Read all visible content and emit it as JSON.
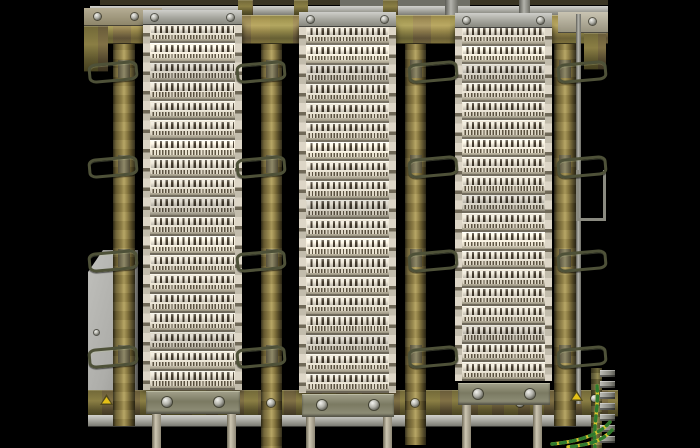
{
  "scene": {
    "subject": "telephone-main-distribution-frame-with-lsa-terminal-block-columns",
    "background": "#000000",
    "palette": {
      "brass_light": "#b7a663",
      "brass_mid": "#8a7b44",
      "brass_dark": "#3a3319",
      "steel_light": "#d2d2ce",
      "steel_mid": "#a9a9a2",
      "steel_dark": "#5c5c55",
      "module_cream": "#e9e2d1",
      "module_contact_dark": "#453c2e",
      "module_shadow": "#99937f",
      "plate_gray": "#b0b0ac",
      "earth_wire_green": "#2f7a2f",
      "earth_wire_yellow": "#d6c62e",
      "warning_yellow": "#e5c117"
    },
    "top": {
      "shadow_strip": [
        100,
        0,
        508,
        5
      ],
      "gray_segment": [
        340,
        0,
        130,
        7
      ],
      "steel_bar": [
        90,
        6,
        518,
        10
      ],
      "brass_rail": [
        90,
        15,
        518,
        29
      ],
      "stubs": [
        [
          238,
          0,
          15,
          16,
          "brass"
        ],
        [
          294,
          0,
          14,
          16,
          "brass"
        ],
        [
          383,
          0,
          15,
          16,
          "brass"
        ],
        [
          445,
          0,
          13,
          16,
          "steel"
        ],
        [
          519,
          0,
          11,
          16,
          "steel"
        ]
      ],
      "left_bracket": {
        "rect": [
          84,
          8,
          78,
          18
        ],
        "screws": [
          [
            97,
            16
          ],
          [
            134,
            16
          ]
        ]
      },
      "left_drop": [
        84,
        26,
        24,
        46
      ],
      "right_cap": {
        "rect": [
          558,
          12,
          50,
          21
        ],
        "screws": [
          [
            592,
            21
          ]
        ]
      },
      "right_drop": [
        584,
        33,
        22,
        37
      ]
    },
    "posts": [
      [
        113,
        14,
        22,
        412
      ],
      [
        261,
        14,
        21,
        434
      ],
      [
        405,
        14,
        21,
        431
      ],
      [
        554,
        14,
        22,
        412
      ]
    ],
    "loop_rows": [
      62,
      157,
      251,
      347
    ],
    "loop_size": [
      44,
      14
    ],
    "loop_dirs": [
      "left",
      "left",
      "right",
      "right"
    ],
    "columns": [
      {
        "rect": [
          143,
          24,
          99,
          366
        ],
        "modules": 19,
        "top_bracket": [
          143,
          10,
          99,
          15
        ],
        "bottom_bracket": [
          146,
          391,
          94,
          23
        ],
        "legs": [
          [
            152,
            414,
            9,
            34
          ],
          [
            227,
            414,
            9,
            34
          ]
        ]
      },
      {
        "rect": [
          299,
          26,
          97,
          367
        ],
        "modules": 19,
        "top_bracket": [
          299,
          12,
          97,
          15
        ],
        "bottom_bracket": [
          302,
          394,
          92,
          23
        ],
        "legs": [
          [
            306,
            417,
            9,
            31
          ],
          [
            383,
            417,
            9,
            31
          ]
        ]
      },
      {
        "rect": [
          455,
          27,
          97,
          354
        ],
        "modules": 19,
        "top_bracket": [
          455,
          13,
          97,
          15
        ],
        "bottom_bracket": [
          458,
          383,
          92,
          22
        ],
        "legs": [
          [
            462,
            405,
            9,
            43
          ],
          [
            533,
            405,
            9,
            43
          ]
        ]
      }
    ],
    "bottom": {
      "brass_rail": [
        88,
        390,
        530,
        27
      ],
      "steel_strip": [
        88,
        415,
        514,
        12
      ],
      "screws": [
        [
          271,
          403
        ],
        [
          415,
          403
        ],
        [
          520,
          403
        ]
      ],
      "warning_triangles": [
        [
          100,
          394
        ],
        [
          570,
          390
        ]
      ]
    },
    "left_plate": {
      "rect": [
        88,
        250,
        50,
        157
      ],
      "screw": [
        96,
        332
      ]
    },
    "right_strip": [
      576,
      14,
      5,
      390
    ],
    "right_hanger": [
      576,
      170,
      24,
      48
    ],
    "earth": {
      "bar": [
        591,
        368,
        11,
        80
      ],
      "clamp_count": 7,
      "clamp_x": 600,
      "clamp_start_y": 370,
      "clamp_step": 11,
      "clamp_w": 15,
      "clamp_h": 7,
      "screw": [
        594,
        398
      ],
      "wires_box": [
        540,
        378,
        160,
        70
      ],
      "wire_paths": [
        "M57,8 C59,28 53,48 55,70",
        "M70,44 C58,58 35,64 12,66",
        "M72,52 C62,64 46,67 28,69"
      ]
    }
  }
}
